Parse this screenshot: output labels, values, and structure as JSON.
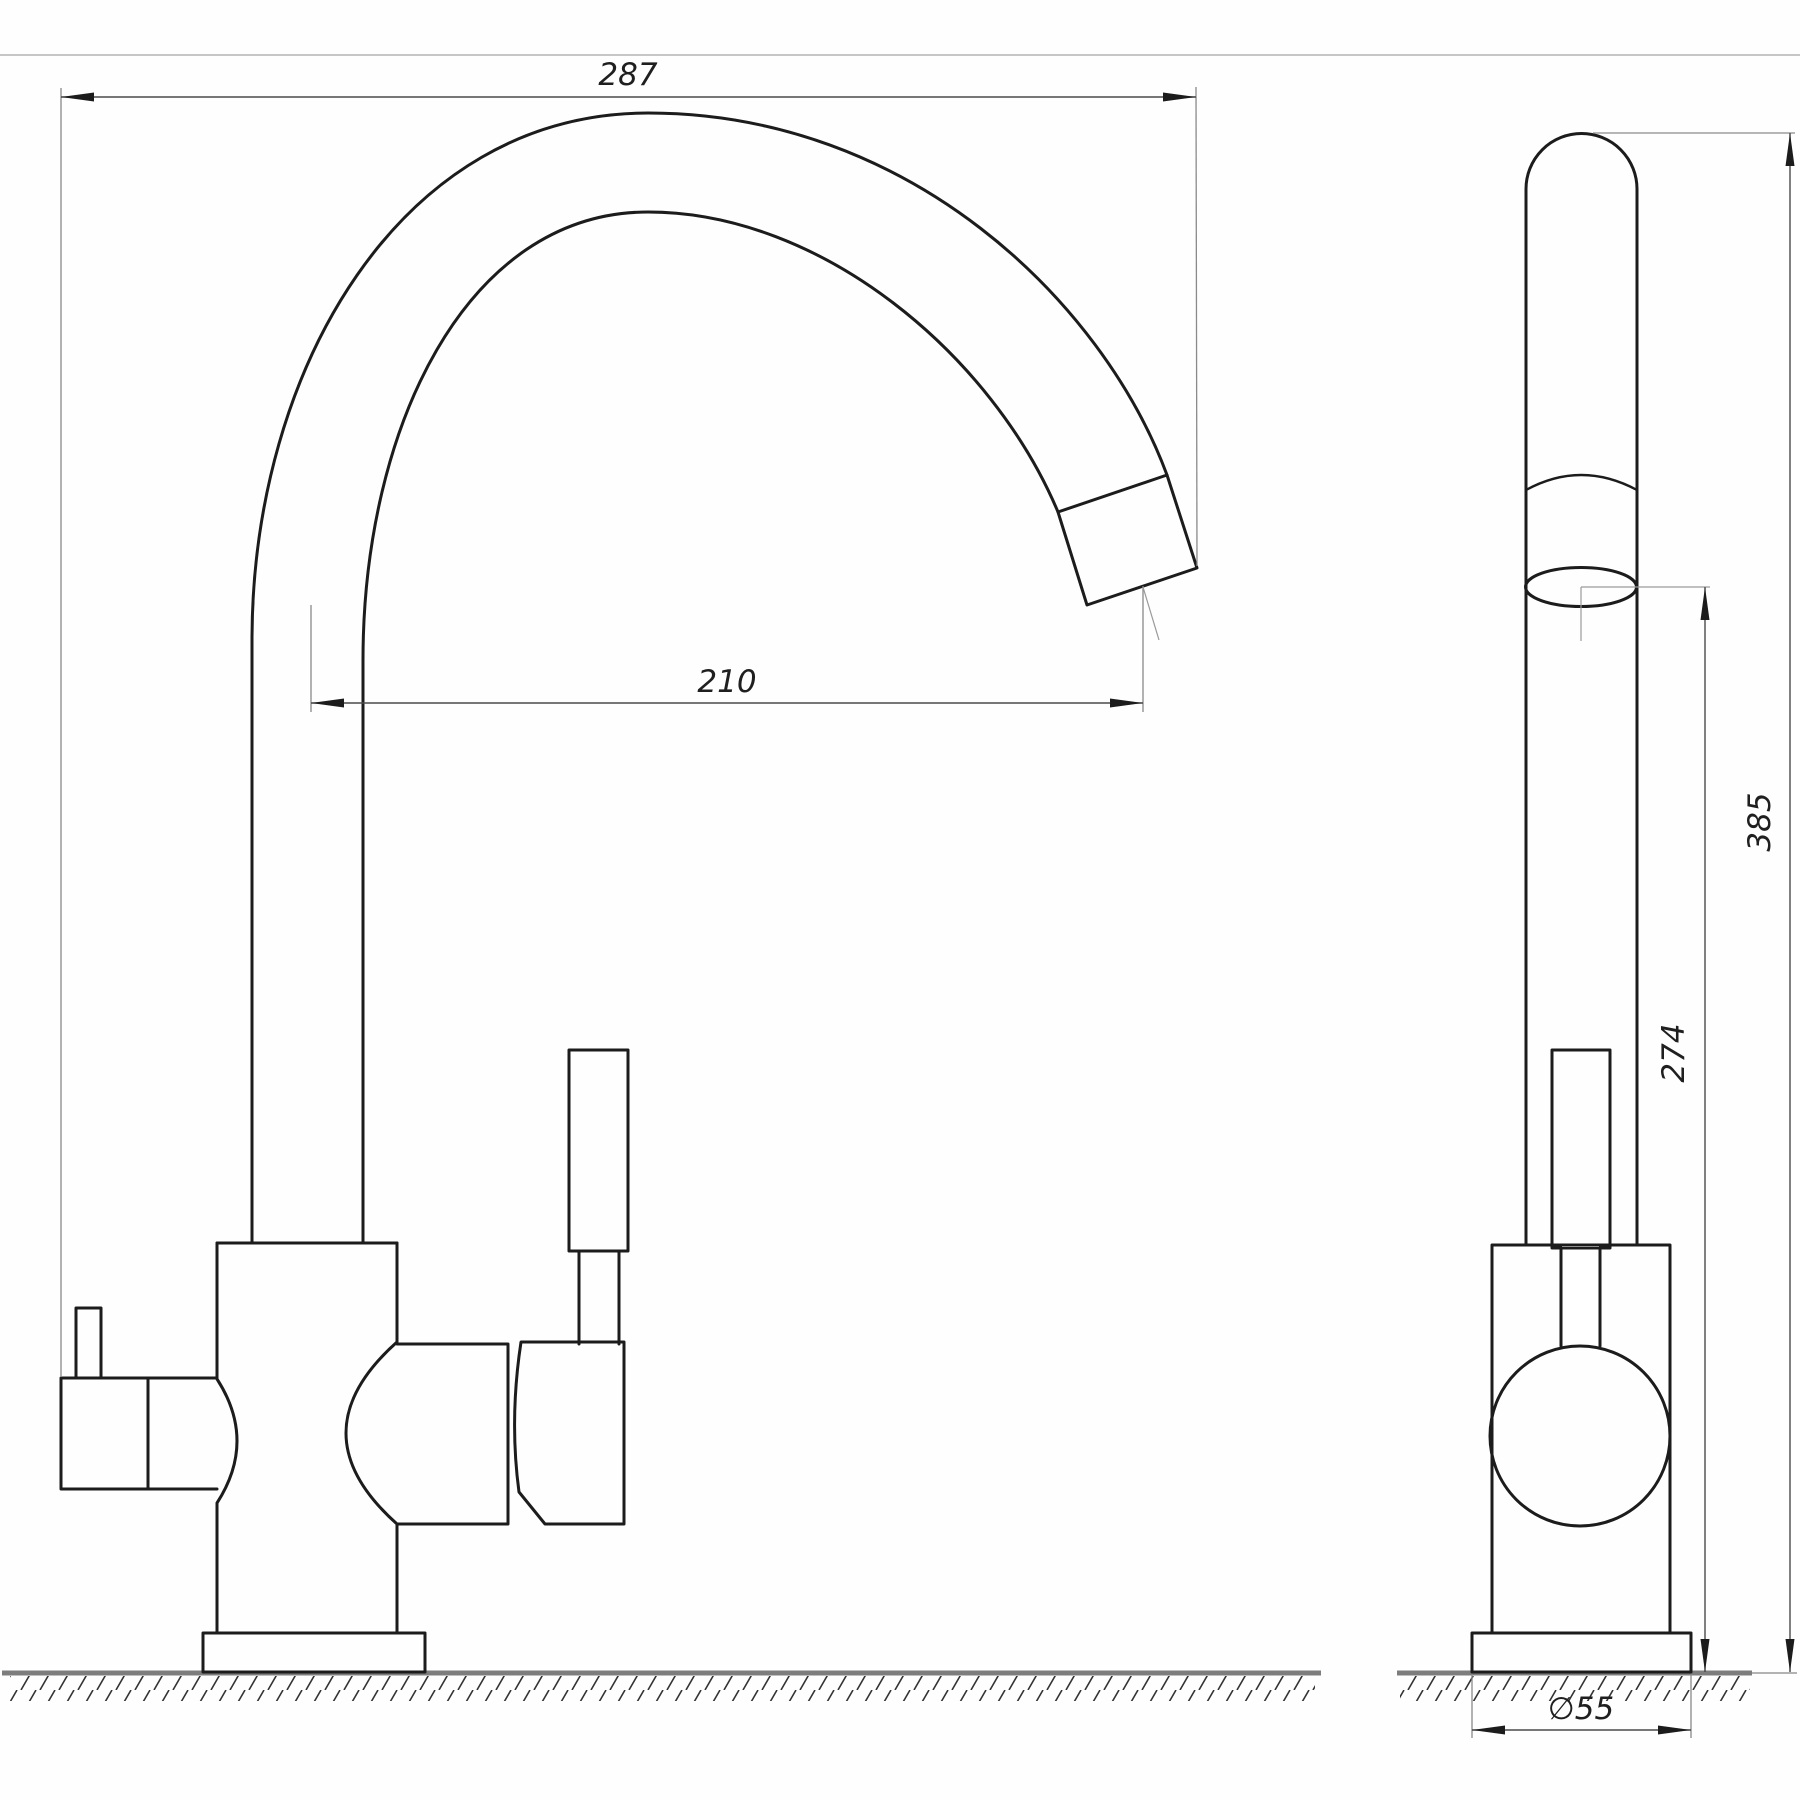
{
  "drawing": {
    "type": "technical-drawing",
    "subject": "kitchen-faucet-two-views",
    "views": {
      "front": {
        "name": "front-view"
      },
      "side": {
        "name": "side-view"
      }
    },
    "dimensions": {
      "overall_width": {
        "label": "287"
      },
      "spout_reach": {
        "label": "210"
      },
      "overall_height": {
        "label": "385"
      },
      "spout_outlet_height": {
        "label": "274"
      },
      "base_diameter": {
        "label": "∅55"
      }
    },
    "colors": {
      "outline": "#1c1c1c",
      "dimension_lines": "#4a4a4a",
      "extension_lines": "#8a8a8a",
      "ground_line": "#7d7d7d",
      "sheet_border": "#b3b3b3",
      "background": "#fefefe"
    }
  }
}
